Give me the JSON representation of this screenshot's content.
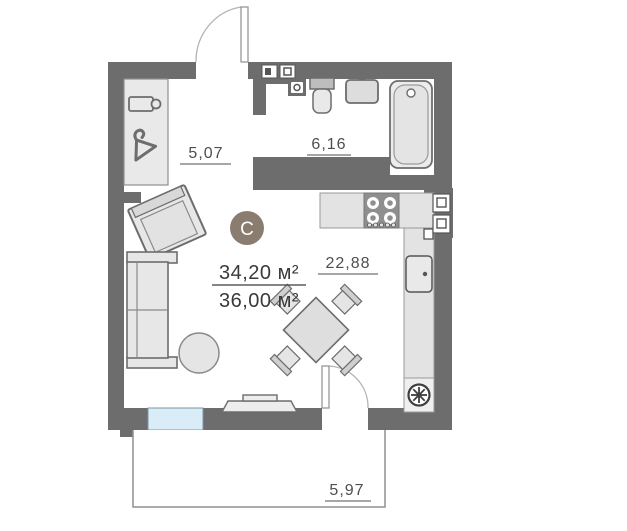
{
  "floor_plan": {
    "compass": {
      "label": "C"
    },
    "areas": {
      "living": "34,20 м²",
      "total": "36,00 м²"
    },
    "rooms": {
      "hallway": {
        "label": "5,07"
      },
      "bathroom": {
        "label": "6,16"
      },
      "living_kitchen": {
        "label": "22,88"
      },
      "balcony": {
        "label": "5,97"
      }
    },
    "colors": {
      "wall": "#6d6d6d",
      "window": "#d9ecf7",
      "compass_badge": "#8a7d70",
      "furniture_fill": "#e7e7e7",
      "counter_fill": "#e3e3e3"
    },
    "icons": [
      "hanger-icon",
      "shelf-icon",
      "toilet-icon",
      "washbasin-icon",
      "bathtub-icon",
      "water-heater-icon",
      "meter-box-icon",
      "stove-icon",
      "kitchen-sink-icon",
      "vent-fan-icon",
      "sofa-icon",
      "armchair-icon",
      "pouf-icon",
      "dining-table-icon",
      "dining-chair-icon",
      "tv-stand-icon",
      "door-icon",
      "window-icon"
    ]
  }
}
